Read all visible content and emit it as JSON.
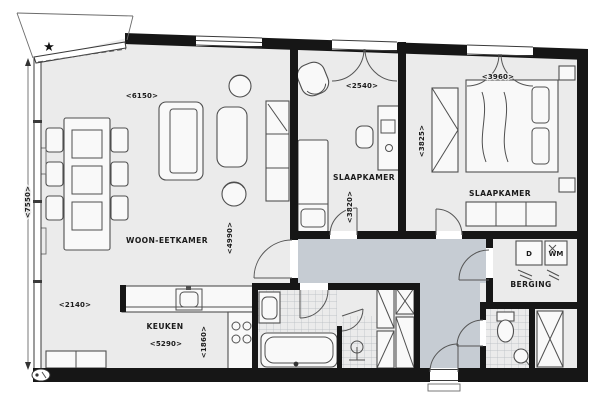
{
  "plan": {
    "symbols": {
      "north_star": "★"
    },
    "rooms": {
      "living": {
        "label": "WOON-EETKAMER",
        "dim_top": "<6150>",
        "dim_left": "<7550>",
        "dim_bottom": "<2140>",
        "dim_mid": "<4990>"
      },
      "bedroom1": {
        "label": "SLAAPKAMER",
        "dim_top": "<2540>",
        "dim_side": "<3820>"
      },
      "bedroom2": {
        "label": "SLAAPKAMER",
        "dim_top": "<3960>",
        "dim_side": "<3825>"
      },
      "kitchen": {
        "label": "KEUKEN",
        "dim_bottom": "<5290>",
        "dim_side": "<1860>"
      },
      "storage": {
        "label": "BERGING",
        "dryer": "D",
        "washer": "WM"
      }
    },
    "colors": {
      "wall": "#161616",
      "room_fill": "#ebebeb",
      "hall_fill": "#c6ccd3",
      "tile_line": "#b5bac0"
    }
  }
}
